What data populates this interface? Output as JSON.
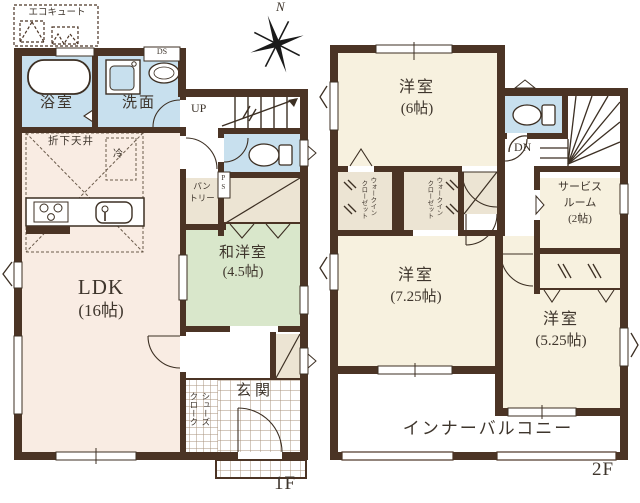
{
  "compass": {
    "north_label": "N"
  },
  "floor1": {
    "floor_label": "1F",
    "ldk": "LDK",
    "ldk_size": "(16帖)",
    "washitsu": "和洋室",
    "washitsu_size": "(4.5帖)",
    "bath": "浴室",
    "washroom": "洗面",
    "genkan": "玄関",
    "pantry_line1": "パン",
    "pantry_line2": "トリー",
    "shoes_closet_col1": "シューズ",
    "shoes_closet_col2": "クローク",
    "eco_cute": "エコキュート",
    "lowered_ceiling": "折下天井",
    "fridge": "冷",
    "stairs_up": "UP",
    "duct_space": "DS",
    "pipe_space": "PS"
  },
  "floor2": {
    "floor_label": "2F",
    "room6": "洋室",
    "room6_size": "(6帖)",
    "room725": "洋室",
    "room725_size": "(7.25帖)",
    "room525": "洋室",
    "room525_size": "(5.25帖)",
    "service_line1": "サービス",
    "service_line2": "ルーム",
    "service_line3": "(2帖)",
    "wic_col1": "ウォークイン",
    "wic_col2": "クローゼット",
    "balcony": "インナーバルコニー",
    "stairs_down": "DN"
  },
  "colors": {
    "wall": "#4b3425",
    "water_room": "#c8e0ee",
    "ldk_fill": "#f9ece3",
    "tatami_fill": "#d9e7cb",
    "room_fill": "#f7f1df",
    "closet_fill": "#ece4d3"
  }
}
